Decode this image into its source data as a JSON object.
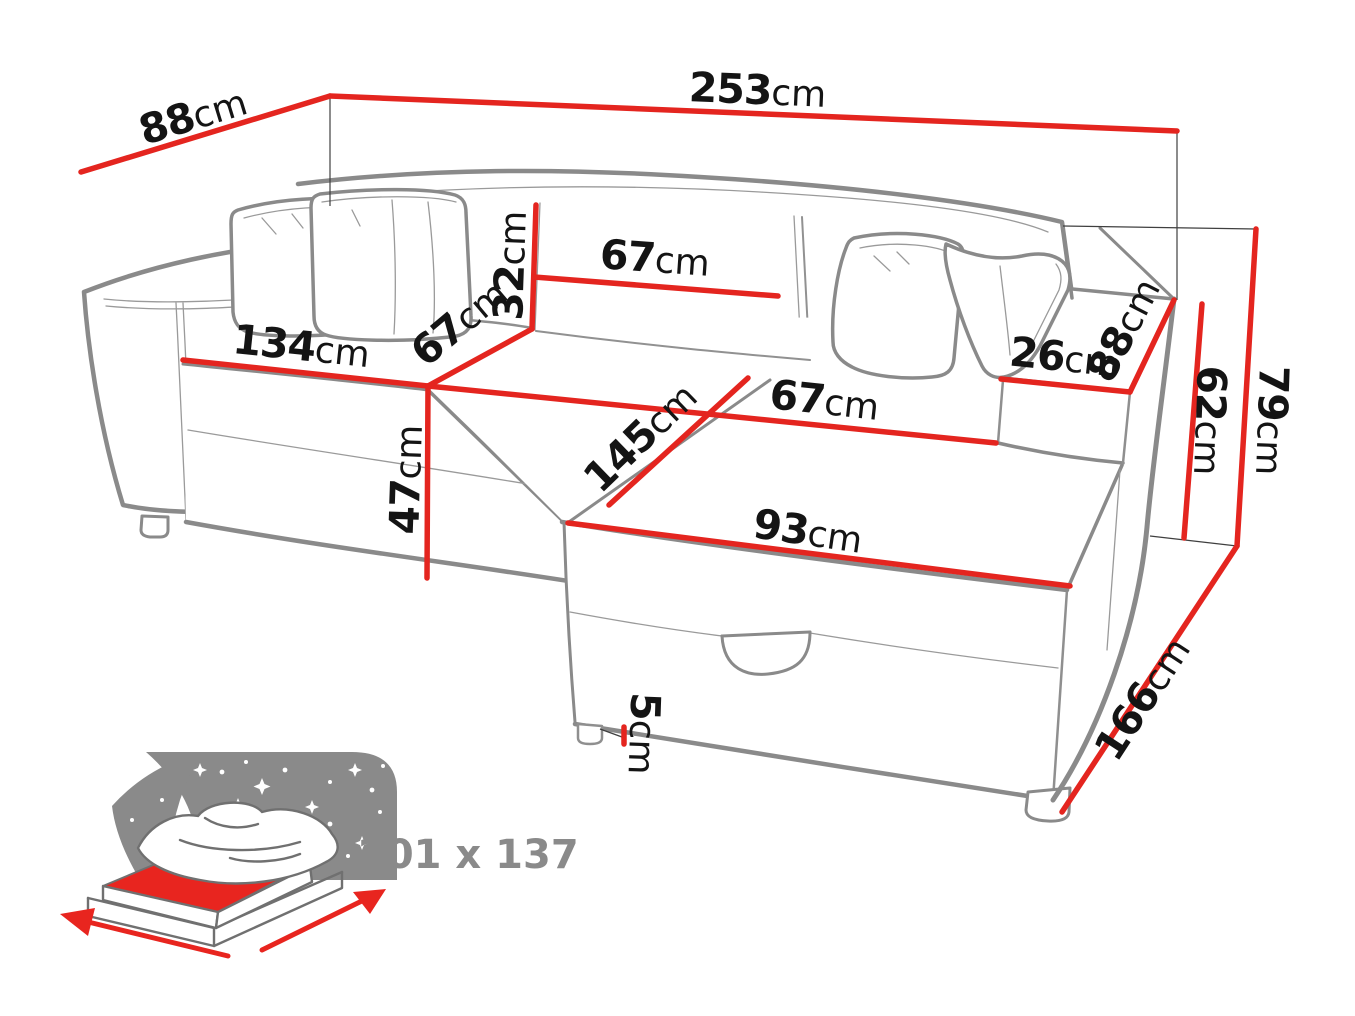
{
  "diagram": {
    "type": "furniture-dimension-diagram",
    "subject": "corner-sofa-bed",
    "unit": "cm",
    "dims": {
      "width_total": {
        "value": "253",
        "unit": "cm"
      },
      "depth_back_left": {
        "value": "88",
        "unit": "cm"
      },
      "backrest_height": {
        "value": "32",
        "unit": "cm"
      },
      "back_cushion_width": {
        "value": "67",
        "unit": "cm"
      },
      "seat_front_width": {
        "value": "134",
        "unit": "cm"
      },
      "seat_depth": {
        "value": "67",
        "unit": "cm"
      },
      "seat_height": {
        "value": "47",
        "unit": "cm"
      },
      "chaise_top_width": {
        "value": "67",
        "unit": "cm"
      },
      "chaise_length": {
        "value": "145",
        "unit": "cm"
      },
      "ottoman_front_width": {
        "value": "93",
        "unit": "cm"
      },
      "armrest_top_width": {
        "value": "26",
        "unit": "cm"
      },
      "armrest_depth": {
        "value": "88",
        "unit": "cm"
      },
      "armrest_height": {
        "value": "62",
        "unit": "cm"
      },
      "height_total": {
        "value": "79",
        "unit": "cm"
      },
      "depth_right": {
        "value": "166",
        "unit": "cm"
      },
      "leg_height": {
        "value": "5",
        "unit": "cm"
      }
    },
    "sleeping_area": {
      "label": "201 x 137"
    },
    "colors": {
      "dimension_red": "#e4251f",
      "outline_gray": "#8a8a8a",
      "label_dark": "#141414",
      "icon_gray": "#8a8a8a",
      "bed_red": "#e8251f"
    }
  }
}
